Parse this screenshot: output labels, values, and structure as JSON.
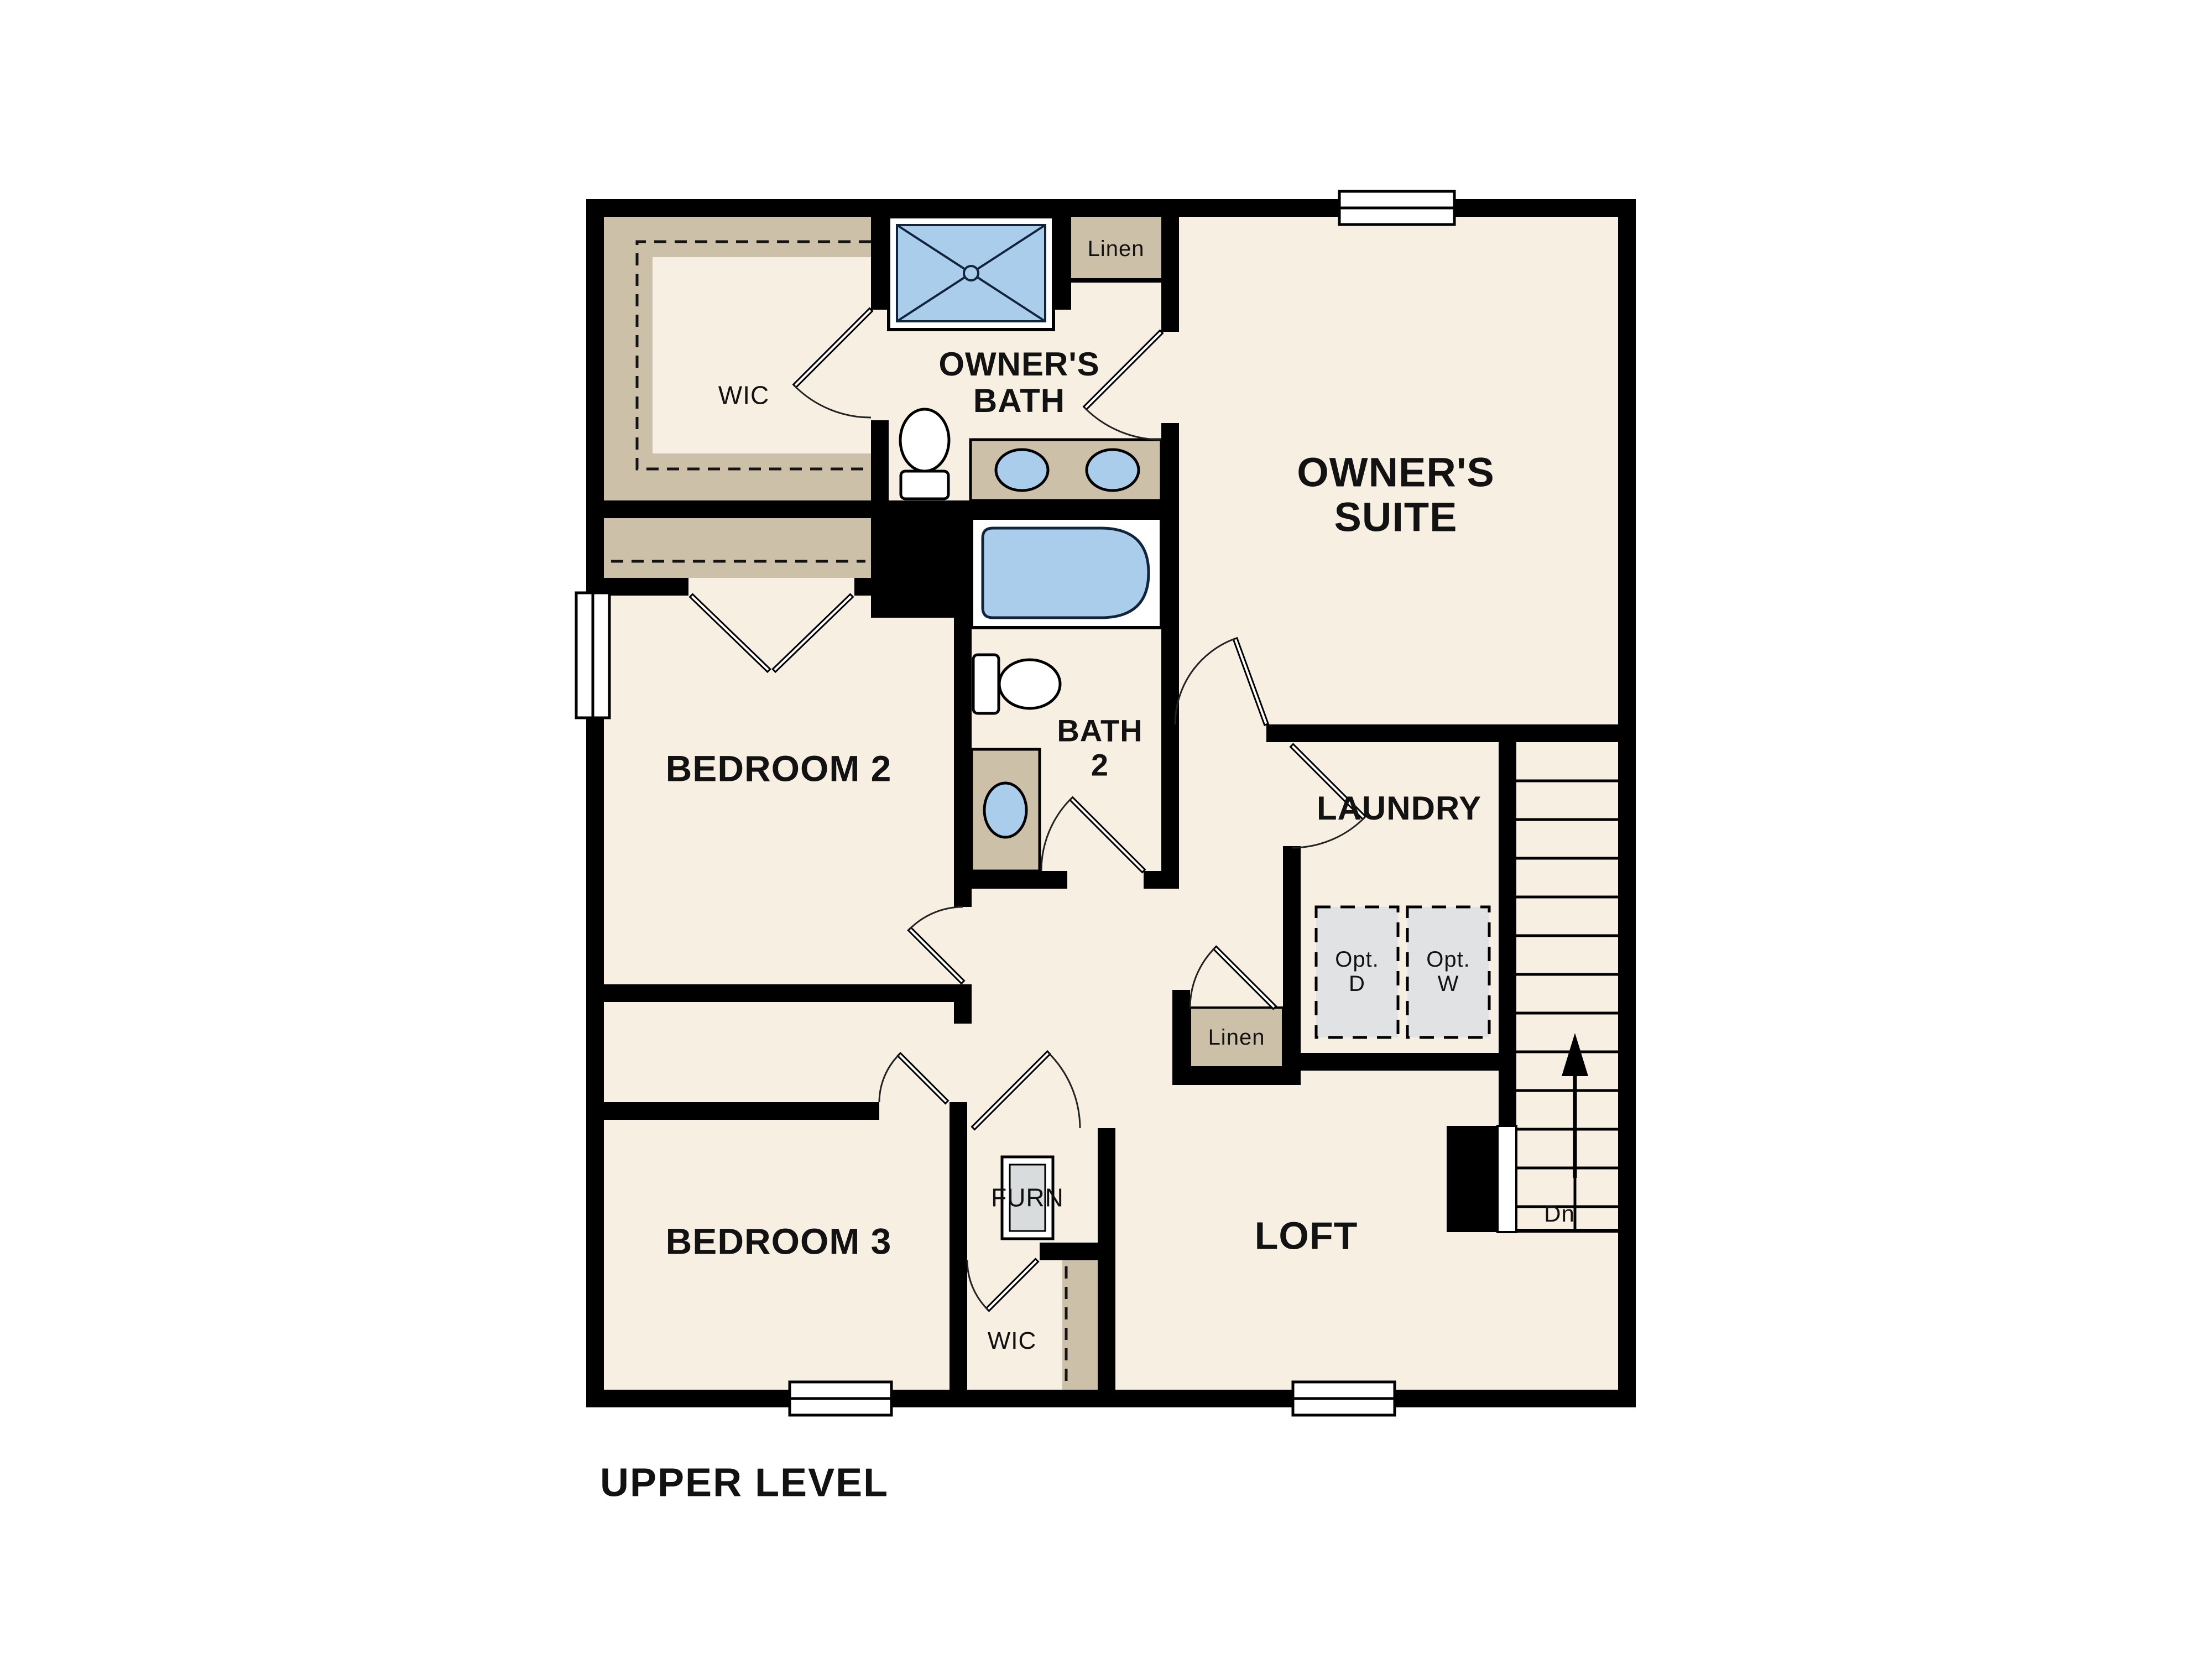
{
  "plan": {
    "floor_name": "UPPER LEVEL",
    "rooms": {
      "wic_top": "WIC",
      "owners_bath": [
        "OWNER'S",
        "BATH"
      ],
      "linen_top": "Linen",
      "owners_suite": [
        "OWNER'S",
        "SUITE"
      ],
      "bedroom2": "BEDROOM 2",
      "bath2": [
        "BATH",
        "2"
      ],
      "laundry": "LAUNDRY",
      "opt_dryer": [
        "Opt.",
        "D"
      ],
      "opt_washer": [
        "Opt.",
        "W"
      ],
      "linen_hall": "Linen",
      "bedroom3": "BEDROOM 3",
      "furnace": "FURN",
      "wic_bottom": "WIC",
      "loft": "LOFT",
      "stairs_down_label": "Dn"
    },
    "colors": {
      "wall": "#000000",
      "floor": "#f6efe2",
      "shelf_tan": "#ccc0a8",
      "fixture_blue": "#abcdec",
      "appliance_gray": "#e0e2e3",
      "background": "#ffffff"
    }
  }
}
